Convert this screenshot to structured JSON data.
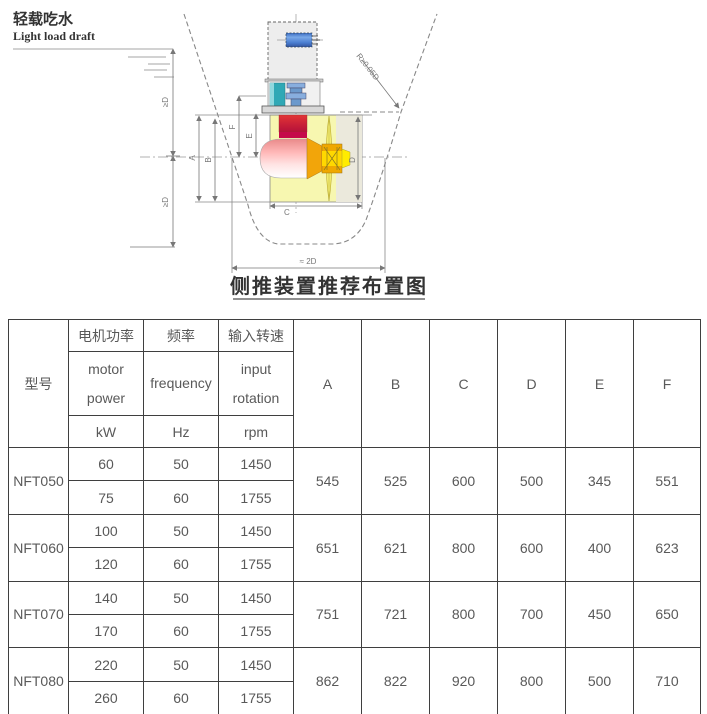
{
  "diagram": {
    "draft_zh": "轻载吃水",
    "draft_en": "Light load draft",
    "ge_d": "≥D",
    "radius_label": "R≥0.05D",
    "approx_2d": "≈ 2D",
    "caption": "侧推装置推荐布置图",
    "dims": {
      "a": "A",
      "b": "B",
      "c": "C",
      "d": "D",
      "e": "E",
      "f": "F"
    }
  },
  "colors": {
    "motor_blue": "#5b8dd9",
    "coupling_teal": "#2fa8b5",
    "gearbox_red": "#d42440",
    "cone_orange": "#f2a50a",
    "tunnel_yellow": "#f7f7b0",
    "hub_yellow": "#ffd800",
    "tip_yellow": "#ffec00",
    "blade_yellow": "#f3ec6e",
    "table_border": "#3f3f3f",
    "header_bg": "#f3f3f3",
    "text_gray": "#595959"
  },
  "table": {
    "header": {
      "model": "型号",
      "columns": [
        {
          "zh": "电机功率",
          "en": "motor power",
          "unit": "kW"
        },
        {
          "zh": "频率",
          "en": "frequency",
          "unit": "Hz"
        },
        {
          "zh": "输入转速",
          "en": "input rotation",
          "unit": "rpm"
        }
      ],
      "dims": [
        "A",
        "B",
        "C",
        "D",
        "E",
        "F"
      ]
    },
    "rows": [
      {
        "model": "NFT050",
        "variants": [
          [
            "60",
            "50",
            "1450"
          ],
          [
            "75",
            "60",
            "1755"
          ]
        ],
        "dims": [
          "545",
          "525",
          "600",
          "500",
          "345",
          "551"
        ]
      },
      {
        "model": "NFT060",
        "variants": [
          [
            "100",
            "50",
            "1450"
          ],
          [
            "120",
            "60",
            "1755"
          ]
        ],
        "dims": [
          "651",
          "621",
          "800",
          "600",
          "400",
          "623"
        ]
      },
      {
        "model": "NFT070",
        "variants": [
          [
            "140",
            "50",
            "1450"
          ],
          [
            "170",
            "60",
            "1755"
          ]
        ],
        "dims": [
          "751",
          "721",
          "800",
          "700",
          "450",
          "650"
        ]
      },
      {
        "model": "NFT080",
        "variants": [
          [
            "220",
            "50",
            "1450"
          ],
          [
            "260",
            "60",
            "1755"
          ]
        ],
        "dims": [
          "862",
          "822",
          "920",
          "800",
          "500",
          "710"
        ]
      }
    ]
  }
}
